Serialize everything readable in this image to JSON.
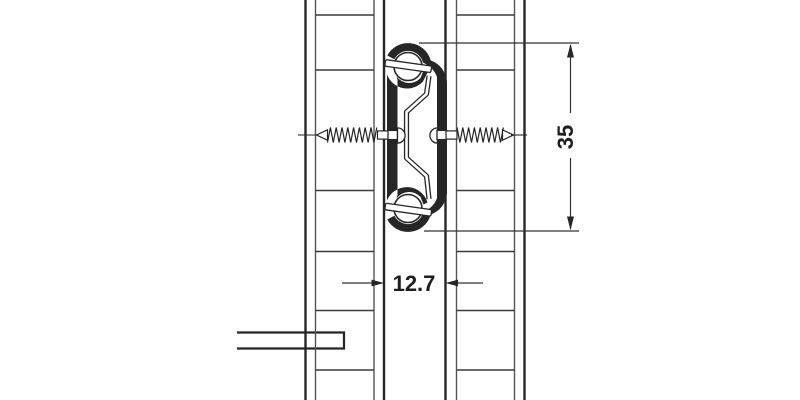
{
  "figure": {
    "background": "#ffffff",
    "heavy_line_color": "#262626",
    "thin_line_color": "#555555",
    "dimension_color": "#333333",
    "dimensions": {
      "height_label": "35",
      "width_label": "12.7"
    },
    "components": {
      "left_panel": "drawer-side-panel",
      "right_panel": "cabinet-side-panel",
      "slide": "ball-bearing-runner-cross-section",
      "screws": "mounting-screws",
      "bottom_bar": "drawer-bottom-panel"
    }
  }
}
